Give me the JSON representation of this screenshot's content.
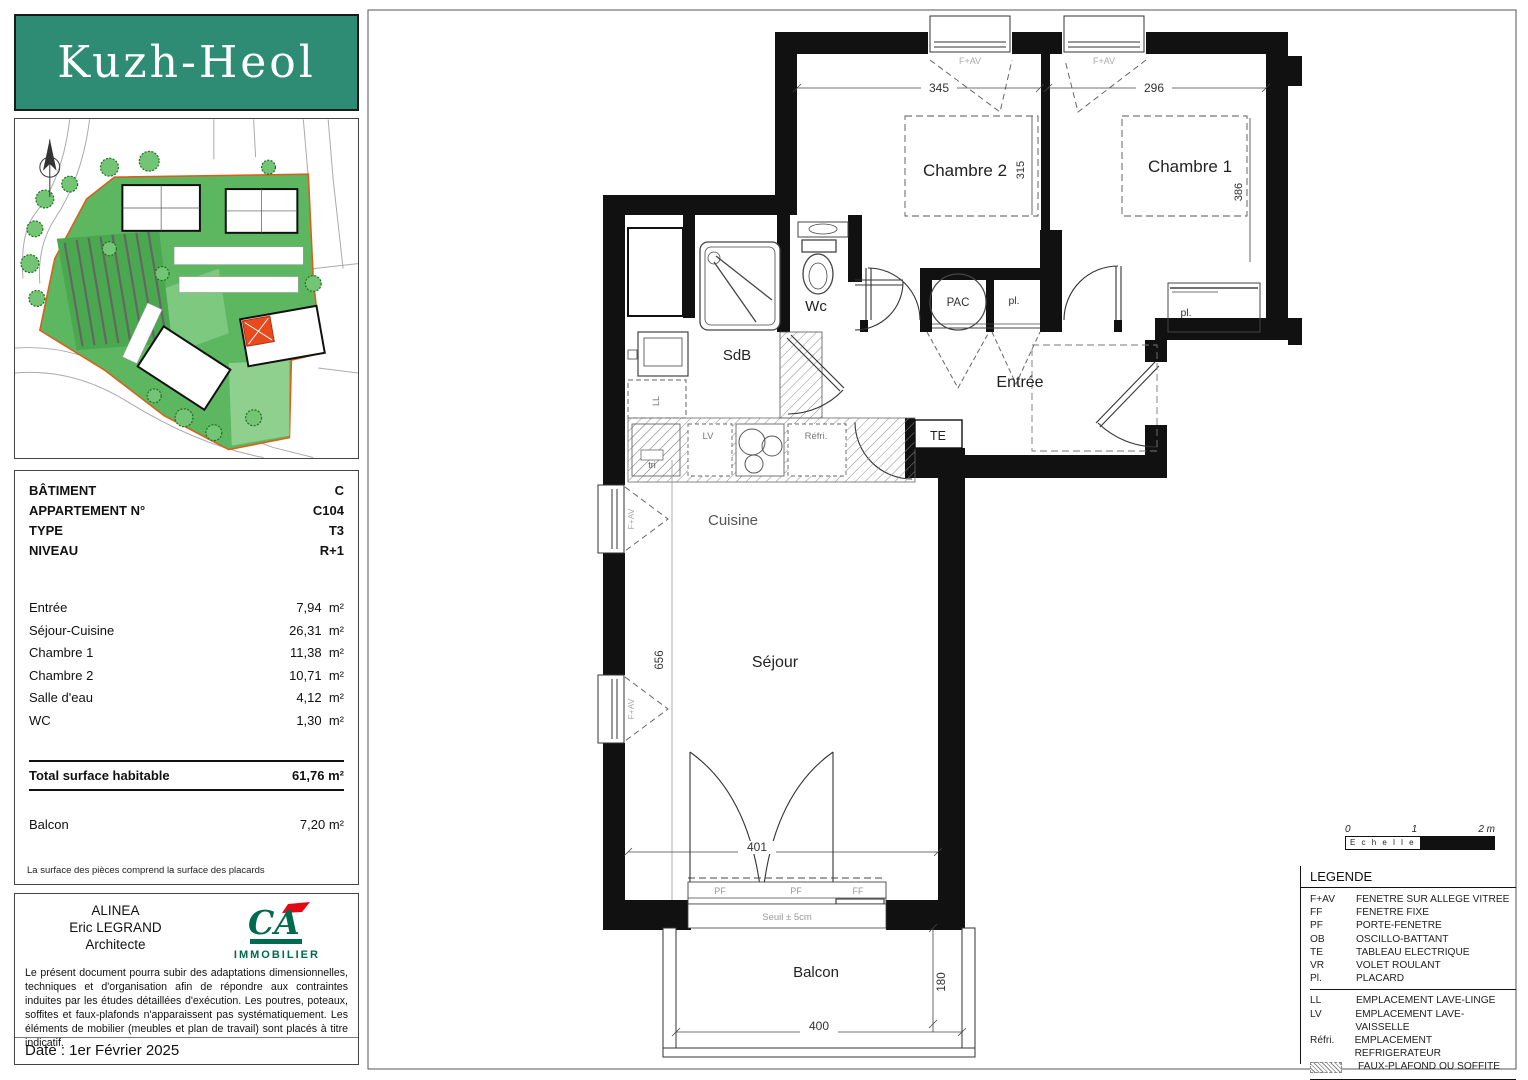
{
  "logo": {
    "title": "Kuzh-Heol",
    "bg_color": "#2e8b74",
    "text_color": "#ffffff"
  },
  "info": {
    "specs": [
      {
        "label": "BÂTIMENT",
        "value": "C"
      },
      {
        "label": "APPARTEMENT N°",
        "value": "C104"
      },
      {
        "label": "TYPE",
        "value": "T3"
      },
      {
        "label": "NIVEAU",
        "value": "R+1"
      }
    ],
    "areas": [
      {
        "label": "Entrée",
        "value": "7,94  m²"
      },
      {
        "label": "Séjour-Cuisine",
        "value": "26,31  m²"
      },
      {
        "label": "Chambre 1",
        "value": "11,38  m²"
      },
      {
        "label": "Chambre 2",
        "value": "10,71  m²"
      },
      {
        "label": "Salle d'eau",
        "value": "4,12  m²"
      },
      {
        "label": "WC",
        "value": "1,30  m²"
      }
    ],
    "total": {
      "label": "Total surface habitable",
      "value": "61,76  m²"
    },
    "balcony": {
      "label": "Balcon",
      "value": "7,20  m²"
    },
    "footnote": "La surface des pièces comprend la surface des placards"
  },
  "architect": {
    "firm": "ALINEA",
    "name": "Eric LEGRAND",
    "role": "Architecte",
    "brand": {
      "mark": "CA",
      "label": "IMMOBILIER",
      "green": "#006a4e",
      "red": "#e30613"
    },
    "disclaimer": "Le présent document pourra subir des adaptations dimensionnelles, techniques et d'organisation afin de répondre aux contraintes induites par les études détaillées d'exécution. Les poutres, poteaux, soffites et faux-plafonds n'apparaissent pas systématiquement. Les éléments de mobilier (meubles et plan de travail) sont placés à titre indicatif.",
    "date": "Date : 1er Février 2025"
  },
  "plan": {
    "rooms": {
      "chambre2": "Chambre 2",
      "chambre1": "Chambre 1",
      "wc": "Wc",
      "sdb": "SdB",
      "entree": "Entrée",
      "cuisine": "Cuisine",
      "sejour": "Séjour",
      "balcon": "Balcon"
    },
    "labels": {
      "pac": "PAC",
      "pl": "pl.",
      "te": "TE",
      "ll": "LL",
      "lv": "LV",
      "tri": "tri",
      "refri": "Réfri.",
      "fav": "F+AV",
      "pf": "PF",
      "ff": "FF",
      "seuil": "Seuil ± 5cm"
    },
    "dims": {
      "ch2_w": "345",
      "ch1_w": "296",
      "ch2_d": "315",
      "ch1_d": "386",
      "sejour_d": "656",
      "sejour_w": "401",
      "balcon_w": "400",
      "balcon_d": "180"
    }
  },
  "scalebar": {
    "t0": "0",
    "t1": "1",
    "t2": "2 m",
    "label": "E c h e l l e"
  },
  "legend": {
    "title": "LEGENDE",
    "items": [
      {
        "abbr": "F+AV",
        "label": "FENETRE SUR ALLEGE VITREE"
      },
      {
        "abbr": "FF",
        "label": "FENETRE FIXE"
      },
      {
        "abbr": "PF",
        "label": "PORTE-FENETRE"
      },
      {
        "abbr": "OB",
        "label": "OSCILLO-BATTANT"
      },
      {
        "abbr": "TE",
        "label": "TABLEAU ELECTRIQUE"
      },
      {
        "abbr": "VR",
        "label": "VOLET ROULANT"
      },
      {
        "abbr": "Pl.",
        "label": "PLACARD"
      }
    ],
    "items2": [
      {
        "abbr": "LL",
        "label": "EMPLACEMENT LAVE-LINGE"
      },
      {
        "abbr": "LV",
        "label": "EMPLACEMENT LAVE-VAISSELLE"
      },
      {
        "abbr": "Réfri.",
        "label": "EMPLACEMENT REFRIGERATEUR"
      },
      {
        "abbr": "",
        "label": "FAUX-PLAFOND OU SOFFITE"
      }
    ]
  }
}
